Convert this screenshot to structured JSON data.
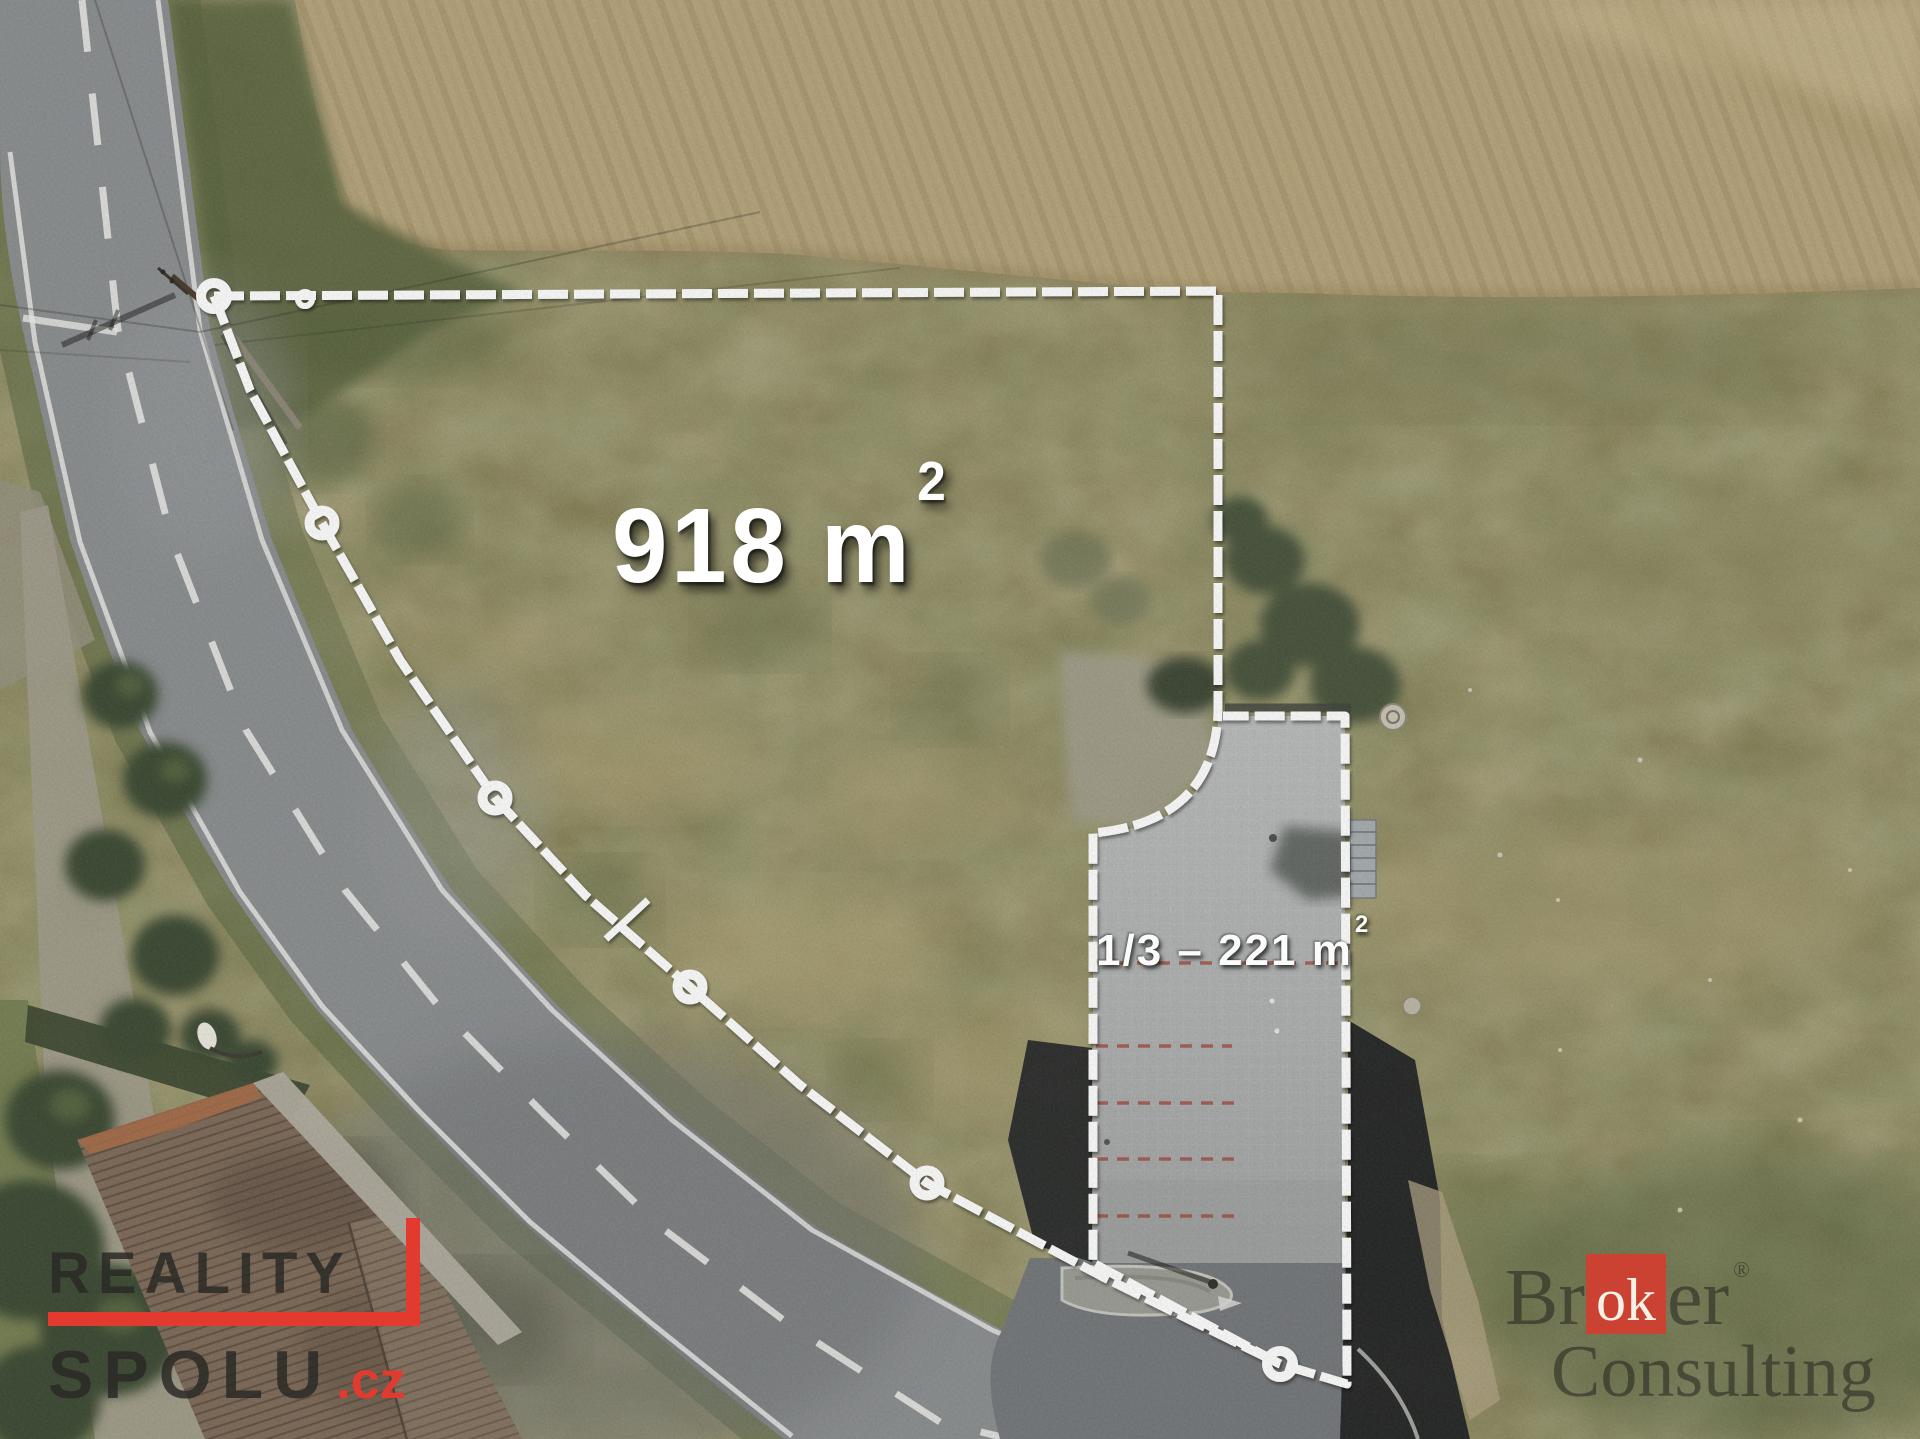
{
  "overlays": {
    "main_area": {
      "value": "918 m",
      "sup": "2"
    },
    "sub_area": {
      "value": "1/3  –  221 m",
      "sup": "2"
    }
  },
  "watermarks": {
    "reality_spolu": {
      "line1": "REALITY",
      "line2": "SPOLU",
      "tld": ".cz",
      "accent_color": "#e23a2e"
    },
    "broker_consulting": {
      "part1": "Br",
      "highlight": "ok",
      "part2": "er",
      "registered": "®",
      "line2": "Consulting",
      "box_color": "#cb4232"
    }
  },
  "colors": {
    "boundary_line": "#ffffff",
    "parking_line": "#a03c2e"
  }
}
